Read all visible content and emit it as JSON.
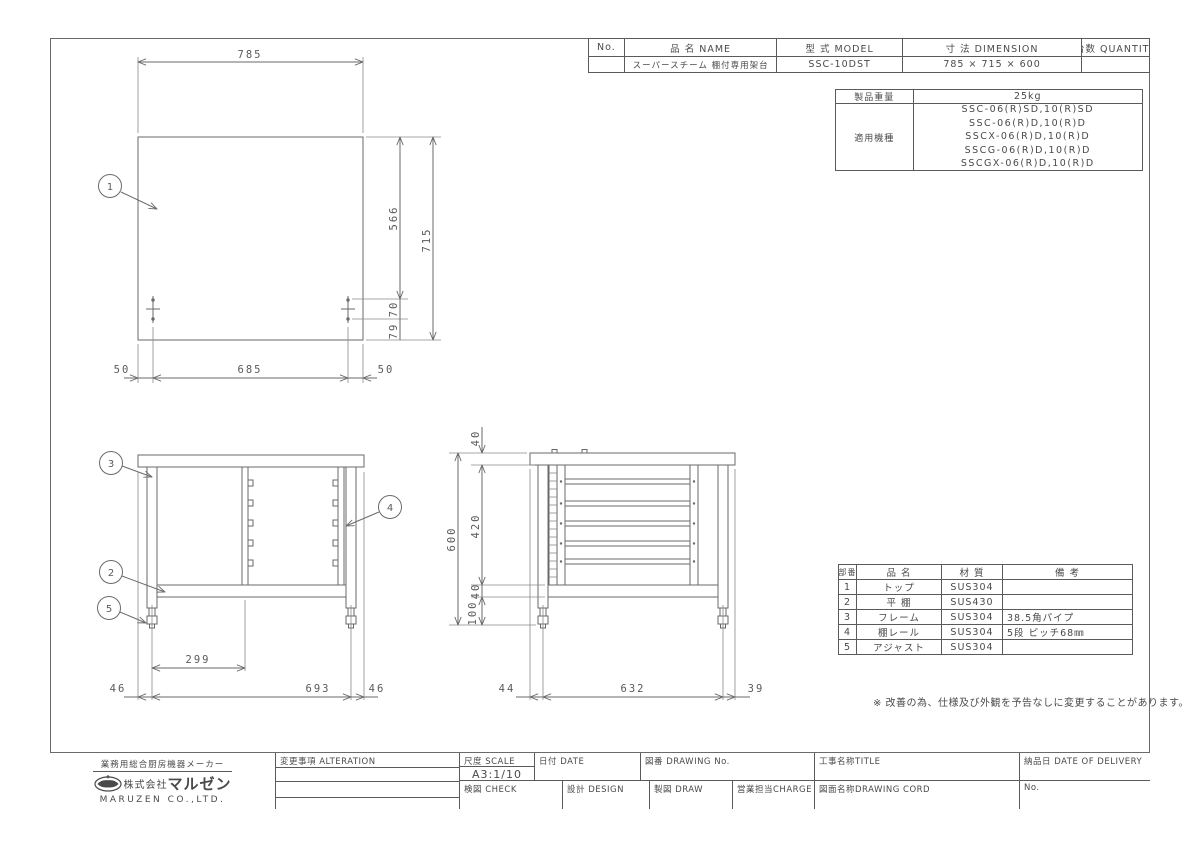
{
  "colors": {
    "line": "#6a6a6a",
    "text": "#4a4a4a",
    "background": "#ffffff"
  },
  "header_table": {
    "columns": {
      "no": "No.",
      "name": "品 名  NAME",
      "model": "型 式  MODEL",
      "dimension": "寸 法  DIMENSION",
      "quantity": "台数 QUANTITY"
    },
    "row": {
      "no": "",
      "name": "スーパースチーム 棚付専用架台",
      "model": "SSC-10DST",
      "dimension": "785 × 715 × 600",
      "quantity": ""
    }
  },
  "product_info": {
    "weight_label": "製品重量",
    "weight_value": "25kg",
    "models_label": "適用機種",
    "models": [
      "SSC-06(R)SD,10(R)SD",
      "SSC-06(R)D,10(R)D",
      "SSCX-06(R)D,10(R)D",
      "SSCG-06(R)D,10(R)D",
      "SSCGX-06(R)D,10(R)D"
    ]
  },
  "parts_table": {
    "headers": {
      "no": "部番",
      "name": "品  名",
      "material": "材  質",
      "note": "備  考"
    },
    "rows": [
      {
        "no": "1",
        "name": "トップ",
        "material": "SUS304",
        "note": ""
      },
      {
        "no": "2",
        "name": "平 棚",
        "material": "SUS430",
        "note": ""
      },
      {
        "no": "3",
        "name": "フレーム",
        "material": "SUS304",
        "note": "38.5角パイプ"
      },
      {
        "no": "4",
        "name": "棚レール",
        "material": "SUS304",
        "note": "5段 ピッチ68㎜"
      },
      {
        "no": "5",
        "name": "アジャスト",
        "material": "SUS304",
        "note": ""
      }
    ]
  },
  "note": "※ 改善の為、仕様及び外観を予告なしに変更することがあります。",
  "balloons": [
    "1",
    "2",
    "3",
    "4",
    "5"
  ],
  "dims": {
    "plan": {
      "width": "785",
      "depth_upper": "566",
      "depth": "715",
      "hole_pitch": "70",
      "hole_to_edge": "79",
      "edge_left": "50",
      "hole_span": "685",
      "edge_right": "50"
    },
    "front": {
      "bay_width": "299",
      "overhang_left": "46",
      "leg_span": "693",
      "overhang_right": "46"
    },
    "side": {
      "top_height": "40",
      "rail_zone": "420",
      "shelf_height": "40",
      "clearance": "100",
      "total_height": "600",
      "overhang_left": "44",
      "leg_span": "632",
      "overhang_right": "39"
    }
  },
  "title_block": {
    "alteration_label": "変更事項  ALTERATION",
    "scale_label": "尺度 SCALE",
    "scale_value": "A3:1/10",
    "date_label": "日付 DATE",
    "drawing_no_label": "図番 DRAWING  No.",
    "title_label": "工事名称TITLE",
    "delivery_label": "納品日  DATE OF DELIVERY",
    "check_label": "検図 CHECK",
    "design_label": "設計 DESIGN",
    "draw_label": "製図 DRAW",
    "charge_label": "営業担当CHARGE",
    "drawing_cord_label": "図面名称DRAWING CORD",
    "no_label": "No.",
    "company": {
      "tagline": "業務用総合厨房機器メーカー",
      "name_prefix": "株式会社",
      "name": "マルゼン",
      "name_en": "MARUZEN CO.,LTD."
    }
  }
}
